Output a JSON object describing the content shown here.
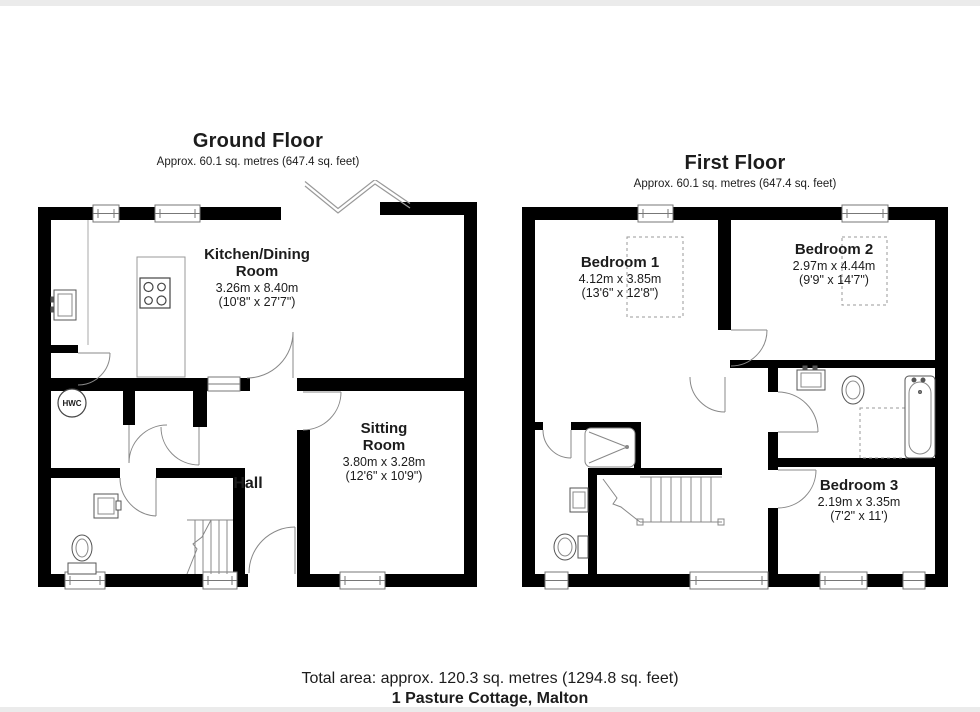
{
  "ground_floor": {
    "title": "Ground Floor",
    "subtitle": "Approx. 60.1 sq. metres (647.4 sq. feet)",
    "rooms": {
      "kitchen": {
        "name_line1": "Kitchen/Dining",
        "name_line2": "Room",
        "metric": "3.26m x 8.40m",
        "imperial": "(10'8\" x 27'7\")"
      },
      "sitting": {
        "name_line1": "Sitting",
        "name_line2": "Room",
        "metric": "3.80m x 3.28m",
        "imperial": "(12'6\" x 10'9\")"
      },
      "hall": {
        "name": "Hall"
      },
      "hwc": {
        "name": "HWC"
      }
    }
  },
  "first_floor": {
    "title": "First Floor",
    "subtitle": "Approx. 60.1 sq. metres (647.4 sq. feet)",
    "rooms": {
      "bedroom1": {
        "name": "Bedroom 1",
        "metric": "4.12m x 3.85m",
        "imperial": "(13'6\" x 12'8\")"
      },
      "bedroom2": {
        "name": "Bedroom 2",
        "metric": "2.97m x 4.44m",
        "imperial": "(9'9\" x 14'7\")"
      },
      "bedroom3": {
        "name": "Bedroom 3",
        "metric": "2.19m x 3.35m",
        "imperial": "(7'2\" x 11')"
      }
    }
  },
  "footer": {
    "total_area": "Total area: approx. 120.3 sq. metres (1294.8 sq. feet)",
    "address": "1 Pasture Cottage, Malton"
  },
  "colors": {
    "wall": "#000000",
    "thin_line": "#888888",
    "text": "#1c1c1c",
    "page_edge": "#ebebeb"
  }
}
